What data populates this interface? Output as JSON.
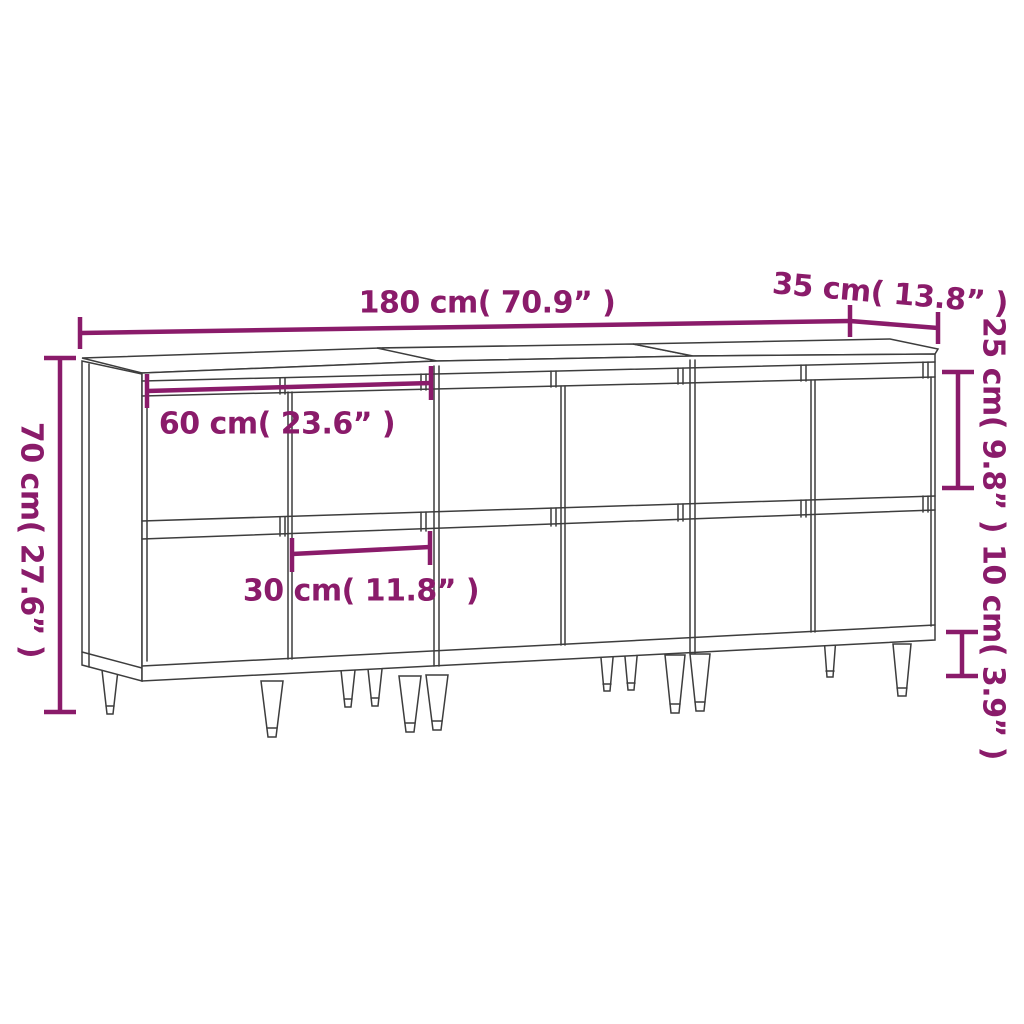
{
  "diagram_title": "Sideboard set dimensions drawing",
  "accent_color": "#8A1B6A",
  "line_color": "#3D3D3D",
  "dimensions": {
    "total_width": "180 cm( 70.9” )",
    "depth": "35 cm( 13.8” )",
    "height": "70 cm( 27.6” )",
    "upper_door_height": "25 cm( 9.8” )",
    "leg_height": "10 cm( 3.9” )",
    "unit_width": "60 cm( 23.6” )",
    "door_width": "30 cm( 11.8” )"
  }
}
